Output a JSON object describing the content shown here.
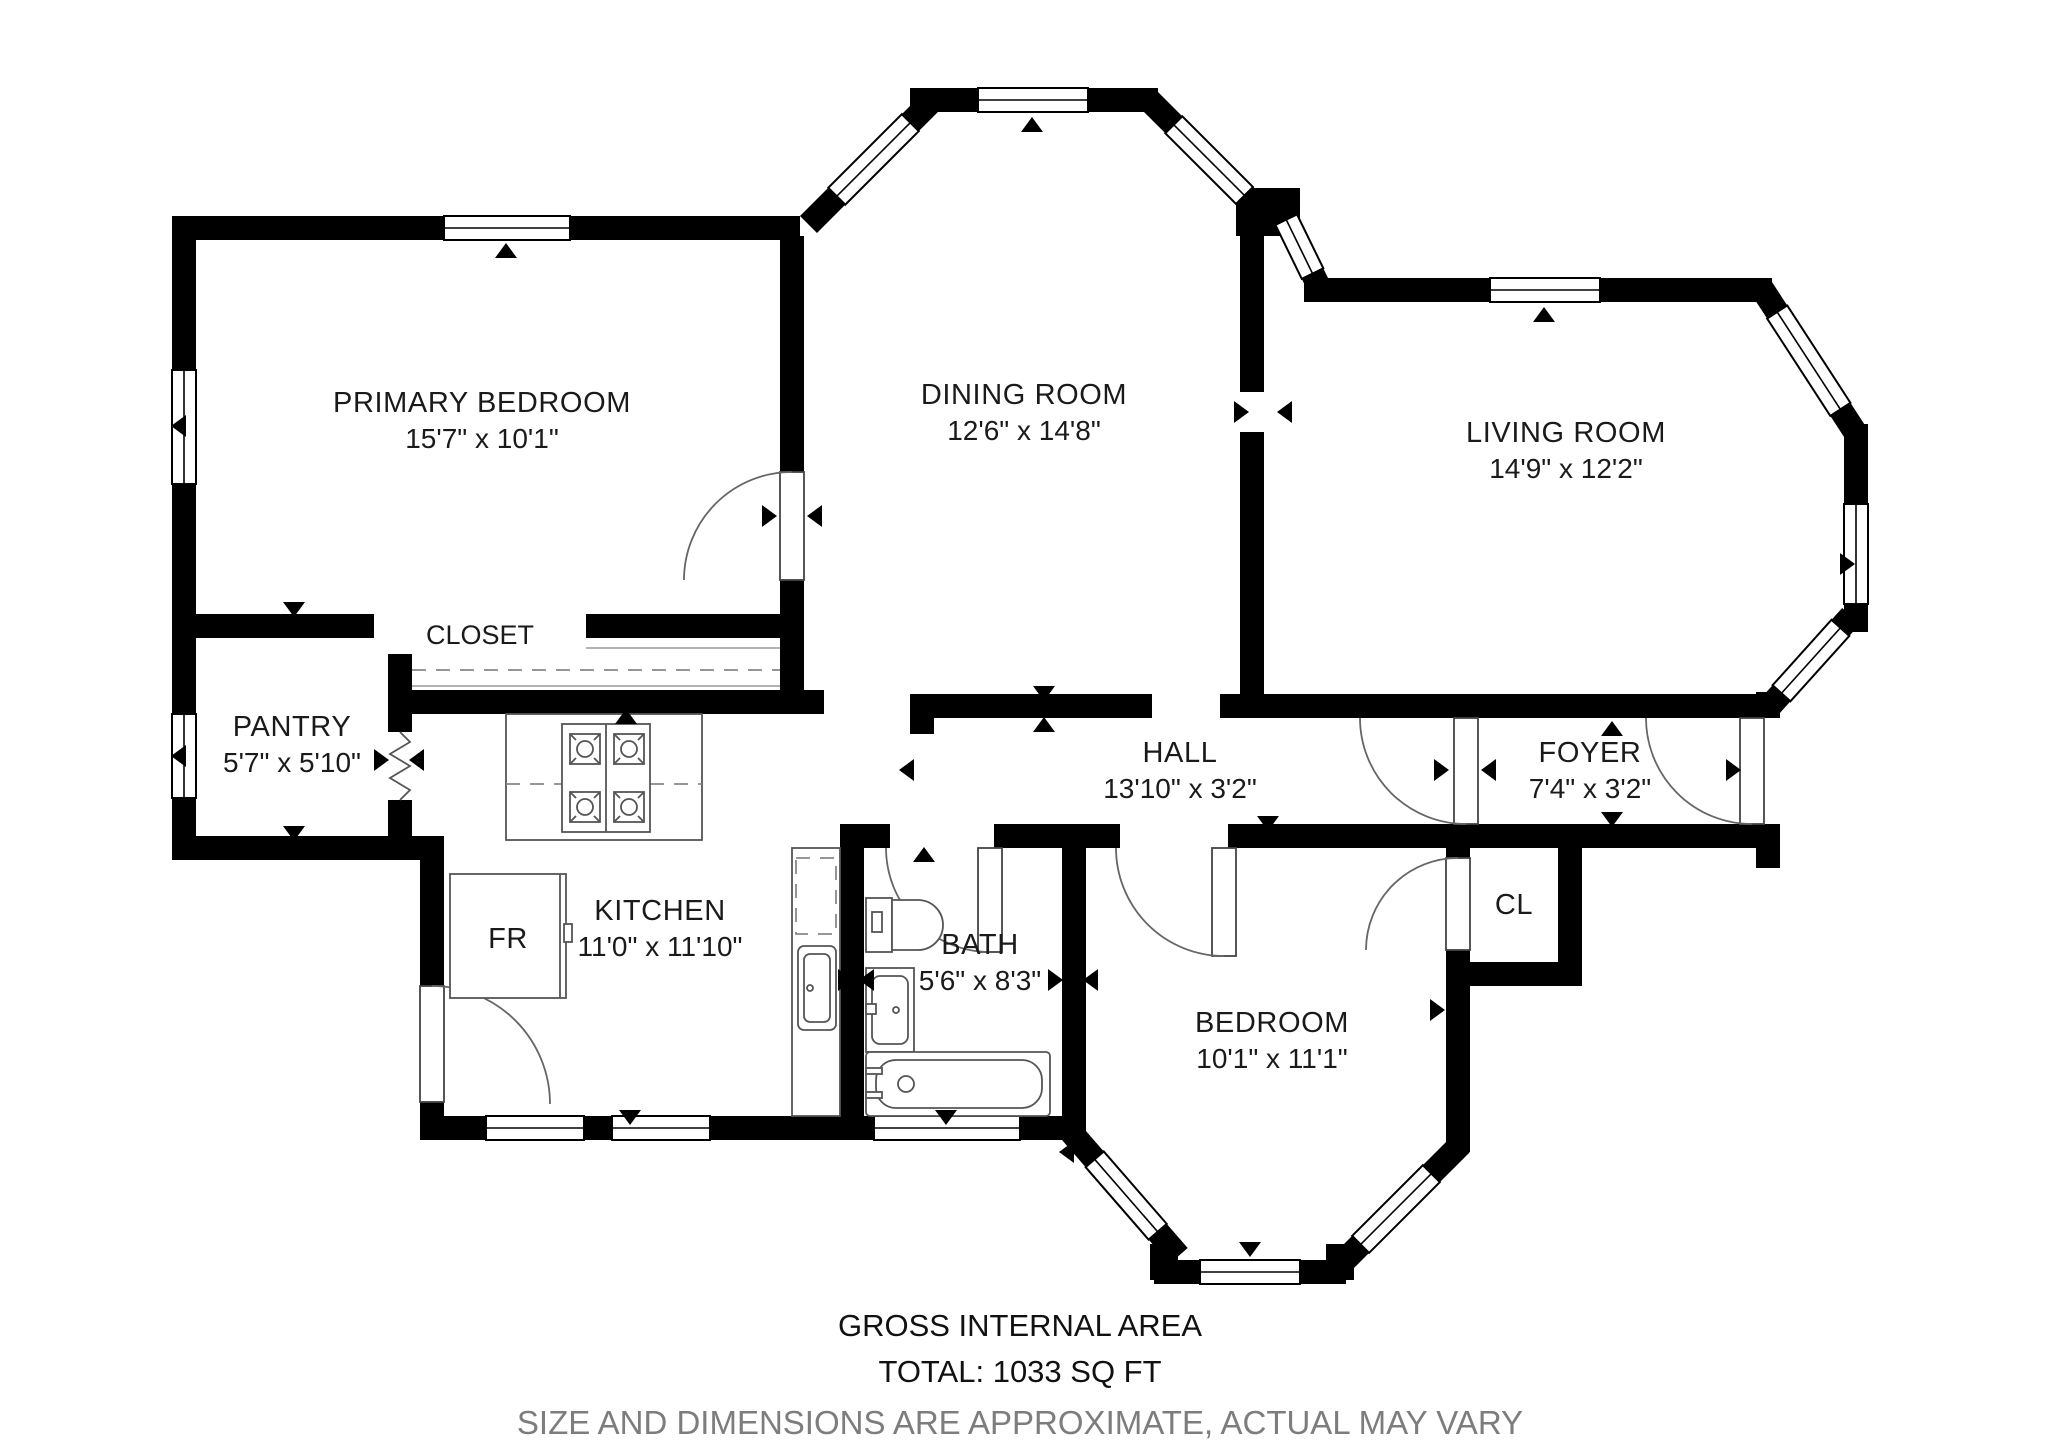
{
  "rooms": {
    "primary_bedroom": {
      "name": "PRIMARY BEDROOM",
      "dims": "15'7\" x 10'1\""
    },
    "dining_room": {
      "name": "DINING ROOM",
      "dims": "12'6\" x 14'8\""
    },
    "living_room": {
      "name": "LIVING ROOM",
      "dims": "14'9\" x 12'2\""
    },
    "closet": {
      "name": "CLOSET"
    },
    "pantry": {
      "name": "PANTRY",
      "dims": "5'7\" x 5'10\""
    },
    "hall": {
      "name": "HALL",
      "dims": "13'10\" x 3'2\""
    },
    "foyer": {
      "name": "FOYER",
      "dims": "7'4\" x 3'2\""
    },
    "kitchen": {
      "name": "KITCHEN",
      "dims": "11'0\" x 11'10\""
    },
    "bath": {
      "name": "BATH",
      "dims": "5'6\" x 8'3\""
    },
    "bedroom": {
      "name": "BEDROOM",
      "dims": "10'1\" x 11'1\""
    },
    "closet_small": {
      "name": "CL"
    }
  },
  "fixtures": {
    "fridge_label": "FR"
  },
  "footer": {
    "line1": "GROSS INTERNAL AREA",
    "line2": "TOTAL: 1033 SQ FT",
    "disclaimer": "SIZE AND DIMENSIONS ARE APPROXIMATE, ACTUAL MAY VARY"
  },
  "colors": {
    "wall": "#000000",
    "thin_line": "#999999",
    "disclaimer_text": "#7d7d7d"
  }
}
